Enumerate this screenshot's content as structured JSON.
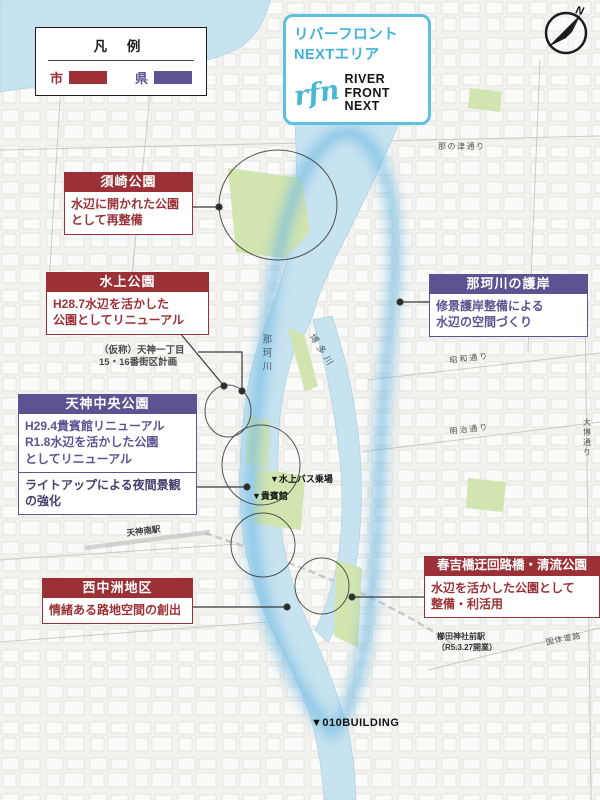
{
  "theme": {
    "city_color": "#9b3136",
    "pref_color": "#5d5292",
    "water_color": "#c8e3f0",
    "park_color": "#d2e4b0",
    "glow_color": "#6fb9e3",
    "badge_blue": "#3fb2d8"
  },
  "legend": {
    "title": "凡 例",
    "city_label": "市",
    "pref_label": "県"
  },
  "badge": {
    "title_line1": "リバーフロント",
    "title_line2": "NEXTエリア",
    "logo_script": "rfn",
    "logo_word1": "RIVER",
    "logo_word2": "FRONT",
    "logo_word3": "NEXT"
  },
  "compass": {
    "label": "N"
  },
  "callouts": {
    "suzaki": {
      "title": "須崎公園",
      "body": "水辺に開かれた公園\nとして再整備"
    },
    "suijo": {
      "title": "水上公園",
      "body": "H28.7水辺を活かした\n公園としてリニューアル"
    },
    "gogan": {
      "title": "那珂川の護岸",
      "body": "修景護岸整備による\n水辺の空間づくり"
    },
    "tenjin_chuo": {
      "title": "天神中央公園",
      "body": "H29.4貴賓館リニューアル\nR1.8水辺を活かした公園\nとしてリニューアル",
      "body2": "ライトアップによる夜間景観\nの強化"
    },
    "nishinakasu": {
      "title": "西中洲地区",
      "body": "情緒ある路地空間の創出"
    },
    "haruyoshi": {
      "title": "春吉橋迂回路橋・清流公園",
      "body": "水辺を活かした公園として\n整備・利活用"
    }
  },
  "map_labels": {
    "tenjin1": "（仮称）天神一丁目\n15・16番街区計画",
    "nanotsu_dori": "那の津通り",
    "nakagawa_river": "那珂川",
    "hakatagawa_river": "博多川",
    "showa_dori": "昭和通り",
    "meiji_dori": "明治通り",
    "taihaku_dori": "大博通り",
    "kokutai_doro": "国体道路",
    "tenjin_minami_sta": "天神南駅",
    "bus_stop": "▼水上バス乗場",
    "kihinkan": "▼貴賓館",
    "building010": "▼010BUILDING",
    "kushida_sta": "櫛田神社前駅\n（R5.3.27開業）"
  }
}
